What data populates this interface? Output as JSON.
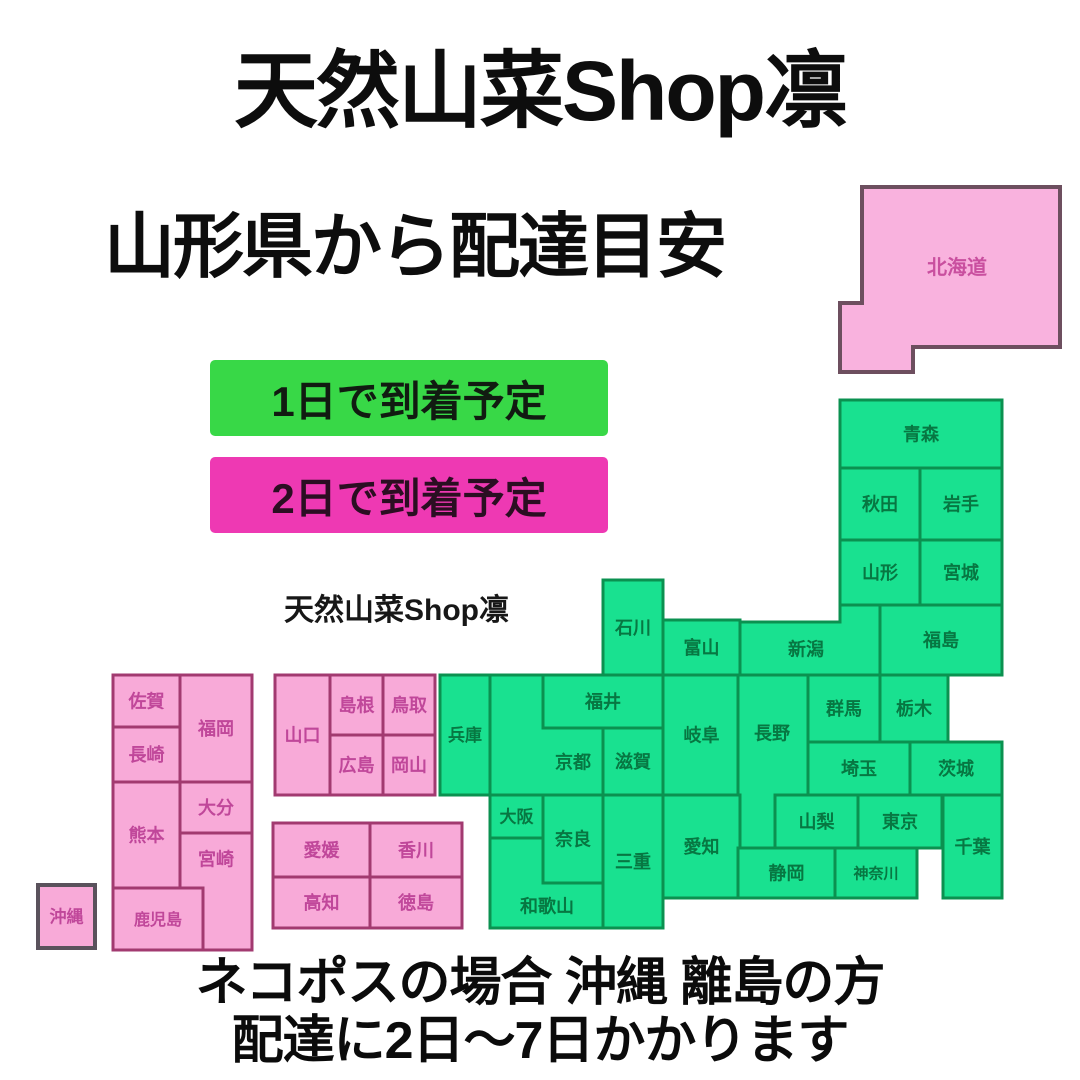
{
  "header": {
    "title": "天然山菜Shop凛",
    "subtitle": "山形県から配達目安"
  },
  "watermark": "天然山菜Shop凛",
  "legend": [
    {
      "id": "one-day",
      "label": "1日で到着予定",
      "fill": "#38d847",
      "text_color": "#111b11"
    },
    {
      "id": "two-day",
      "label": "2日で到着予定",
      "fill": "#ee39b3",
      "text_color": "#2b0e22"
    }
  ],
  "footer": {
    "line1": "ネコポスの場合 沖縄 離島の方",
    "line2": "配達に2日〜7日かかります"
  },
  "map": {
    "styles": {
      "one_day": {
        "fill": "#19e190",
        "stroke": "#0b9150",
        "label": "#077742",
        "stroke_width": 3
      },
      "two_day": {
        "fill": "#f8aad8",
        "stroke": "#a23a70",
        "label": "#c0479a",
        "stroke_width": 3
      },
      "hokkaido": {
        "fill": "#f9b2de",
        "stroke": "#6d4f5f",
        "label": "#c94f9f",
        "stroke_width": 4
      },
      "okinawa": {
        "fill": "#f8aad8",
        "stroke": "#5a525c",
        "label": "#c0479a",
        "stroke_width": 4
      }
    },
    "prefectures": [
      {
        "id": "hokkaido",
        "label": "北海道",
        "style": "hokkaido",
        "points": [
          [
            862,
            187
          ],
          [
            1060,
            187
          ],
          [
            1060,
            347
          ],
          [
            913,
            347
          ],
          [
            913,
            372
          ],
          [
            840,
            372
          ],
          [
            840,
            303
          ],
          [
            862,
            303
          ]
        ],
        "label_pos": [
          957,
          267
        ],
        "font_size": 20
      },
      {
        "id": "aomori",
        "label": "青森",
        "style": "one_day",
        "rect": [
          840,
          400,
          162,
          68
        ]
      },
      {
        "id": "akita",
        "label": "秋田",
        "style": "one_day",
        "rect": [
          840,
          468,
          80,
          72
        ]
      },
      {
        "id": "iwate",
        "label": "岩手",
        "style": "one_day",
        "rect": [
          920,
          468,
          82,
          72
        ]
      },
      {
        "id": "yamagata",
        "label": "山形",
        "style": "one_day",
        "rect": [
          840,
          540,
          80,
          65
        ]
      },
      {
        "id": "miyagi",
        "label": "宮城",
        "style": "one_day",
        "rect": [
          920,
          540,
          82,
          65
        ]
      },
      {
        "id": "fukushima",
        "label": "福島",
        "style": "one_day",
        "rect": [
          880,
          605,
          122,
          70
        ]
      },
      {
        "id": "niigata",
        "label": "新潟",
        "style": "one_day",
        "points": [
          [
            738,
            622
          ],
          [
            840,
            622
          ],
          [
            840,
            605
          ],
          [
            880,
            605
          ],
          [
            880,
            675
          ],
          [
            738,
            675
          ]
        ],
        "label_pos": [
          806,
          649
        ]
      },
      {
        "id": "ishikawa",
        "label": "石川",
        "style": "one_day",
        "rect": [
          603,
          580,
          60,
          95
        ]
      },
      {
        "id": "toyama",
        "label": "富山",
        "style": "one_day",
        "rect": [
          663,
          620,
          77,
          55
        ]
      },
      {
        "id": "fukui",
        "label": "福井",
        "style": "one_day",
        "rect": [
          543,
          675,
          120,
          53
        ]
      },
      {
        "id": "gifu",
        "label": "岐阜",
        "style": "one_day",
        "rect": [
          663,
          675,
          77,
          120
        ]
      },
      {
        "id": "nagano",
        "label": "長野",
        "style": "one_day",
        "points": [
          [
            738,
            675
          ],
          [
            808,
            675
          ],
          [
            808,
            795
          ],
          [
            775,
            795
          ],
          [
            775,
            848
          ],
          [
            738,
            848
          ]
        ],
        "label_pos": [
          772,
          733
        ]
      },
      {
        "id": "gunma",
        "label": "群馬",
        "style": "one_day",
        "rect": [
          808,
          675,
          72,
          67
        ]
      },
      {
        "id": "tochigi",
        "label": "栃木",
        "style": "one_day",
        "rect": [
          880,
          675,
          68,
          67
        ]
      },
      {
        "id": "saitama",
        "label": "埼玉",
        "style": "one_day",
        "rect": [
          808,
          742,
          102,
          53
        ]
      },
      {
        "id": "ibaraki",
        "label": "茨城",
        "style": "one_day",
        "rect": [
          910,
          742,
          92,
          53
        ]
      },
      {
        "id": "hyogo",
        "label": "兵庫",
        "style": "one_day",
        "rect": [
          440,
          675,
          50,
          120
        ],
        "font_size": 17
      },
      {
        "id": "kyoto",
        "label": "京都",
        "style": "one_day",
        "points": [
          [
            490,
            675
          ],
          [
            543,
            675
          ],
          [
            543,
            728
          ],
          [
            603,
            728
          ],
          [
            603,
            795
          ],
          [
            490,
            795
          ]
        ],
        "label_pos": [
          573,
          762
        ]
      },
      {
        "id": "shiga",
        "label": "滋賀",
        "style": "one_day",
        "rect": [
          603,
          728,
          60,
          67
        ]
      },
      {
        "id": "osaka",
        "label": "大阪",
        "style": "one_day",
        "rect": [
          490,
          795,
          53,
          43
        ],
        "font_size": 17
      },
      {
        "id": "nara",
        "label": "奈良",
        "style": "one_day",
        "rect": [
          543,
          795,
          60,
          88
        ]
      },
      {
        "id": "mie",
        "label": "三重",
        "style": "one_day",
        "rect": [
          603,
          795,
          60,
          133
        ]
      },
      {
        "id": "wakayama",
        "label": "和歌山",
        "style": "one_day",
        "points": [
          [
            490,
            838
          ],
          [
            543,
            838
          ],
          [
            543,
            883
          ],
          [
            603,
            883
          ],
          [
            603,
            928
          ],
          [
            490,
            928
          ]
        ],
        "label_pos": [
          547,
          906
        ]
      },
      {
        "id": "aichi",
        "label": "愛知",
        "style": "one_day",
        "rect": [
          663,
          795,
          77,
          103
        ]
      },
      {
        "id": "yamanashi",
        "label": "山梨",
        "style": "one_day",
        "rect": [
          775,
          795,
          83,
          53
        ]
      },
      {
        "id": "tokyo",
        "label": "東京",
        "style": "one_day",
        "rect": [
          858,
          795,
          84,
          53
        ]
      },
      {
        "id": "chiba",
        "label": "千葉",
        "style": "one_day",
        "rect": [
          943,
          795,
          59,
          103
        ]
      },
      {
        "id": "shizuoka",
        "label": "静岡",
        "style": "one_day",
        "rect": [
          738,
          848,
          97,
          50
        ]
      },
      {
        "id": "kanagawa",
        "label": "神奈川",
        "style": "one_day",
        "rect": [
          835,
          848,
          82,
          50
        ],
        "font_size": 15
      },
      {
        "id": "yamaguchi",
        "label": "山口",
        "style": "two_day",
        "rect": [
          275,
          675,
          55,
          120
        ]
      },
      {
        "id": "shimane",
        "label": "島根",
        "style": "two_day",
        "rect": [
          330,
          675,
          53,
          60
        ]
      },
      {
        "id": "tottori",
        "label": "鳥取",
        "style": "two_day",
        "rect": [
          383,
          675,
          52,
          60
        ]
      },
      {
        "id": "hiroshima",
        "label": "広島",
        "style": "two_day",
        "rect": [
          330,
          735,
          53,
          60
        ]
      },
      {
        "id": "okayama",
        "label": "岡山",
        "style": "two_day",
        "rect": [
          383,
          735,
          52,
          60
        ]
      },
      {
        "id": "saga",
        "label": "佐賀",
        "style": "two_day",
        "rect": [
          113,
          675,
          67,
          52
        ]
      },
      {
        "id": "fukuoka",
        "label": "福岡",
        "style": "two_day",
        "rect": [
          180,
          675,
          72,
          107
        ]
      },
      {
        "id": "nagasaki",
        "label": "長崎",
        "style": "two_day",
        "rect": [
          113,
          727,
          67,
          55
        ]
      },
      {
        "id": "kumamoto",
        "label": "熊本",
        "style": "two_day",
        "rect": [
          113,
          782,
          67,
          106
        ]
      },
      {
        "id": "oita",
        "label": "大分",
        "style": "two_day",
        "rect": [
          180,
          782,
          72,
          51
        ]
      },
      {
        "id": "miyazaki",
        "label": "宮崎",
        "style": "two_day",
        "points": [
          [
            180,
            833
          ],
          [
            252,
            833
          ],
          [
            252,
            950
          ],
          [
            203,
            950
          ],
          [
            203,
            888
          ],
          [
            180,
            888
          ]
        ],
        "label_pos": [
          216,
          859
        ]
      },
      {
        "id": "kagoshima",
        "label": "鹿児島",
        "style": "two_day",
        "rect": [
          113,
          888,
          90,
          62
        ],
        "font_size": 16
      },
      {
        "id": "ehime",
        "label": "愛媛",
        "style": "two_day",
        "rect": [
          273,
          823,
          97,
          54
        ]
      },
      {
        "id": "kagawa",
        "label": "香川",
        "style": "two_day",
        "rect": [
          370,
          823,
          92,
          54
        ]
      },
      {
        "id": "kochi",
        "label": "高知",
        "style": "two_day",
        "rect": [
          273,
          877,
          97,
          51
        ]
      },
      {
        "id": "tokushima",
        "label": "徳島",
        "style": "two_day",
        "rect": [
          370,
          877,
          92,
          51
        ]
      },
      {
        "id": "okinawa",
        "label": "沖縄",
        "style": "okinawa",
        "rect": [
          38,
          885,
          57,
          63
        ],
        "font_size": 17
      }
    ]
  }
}
